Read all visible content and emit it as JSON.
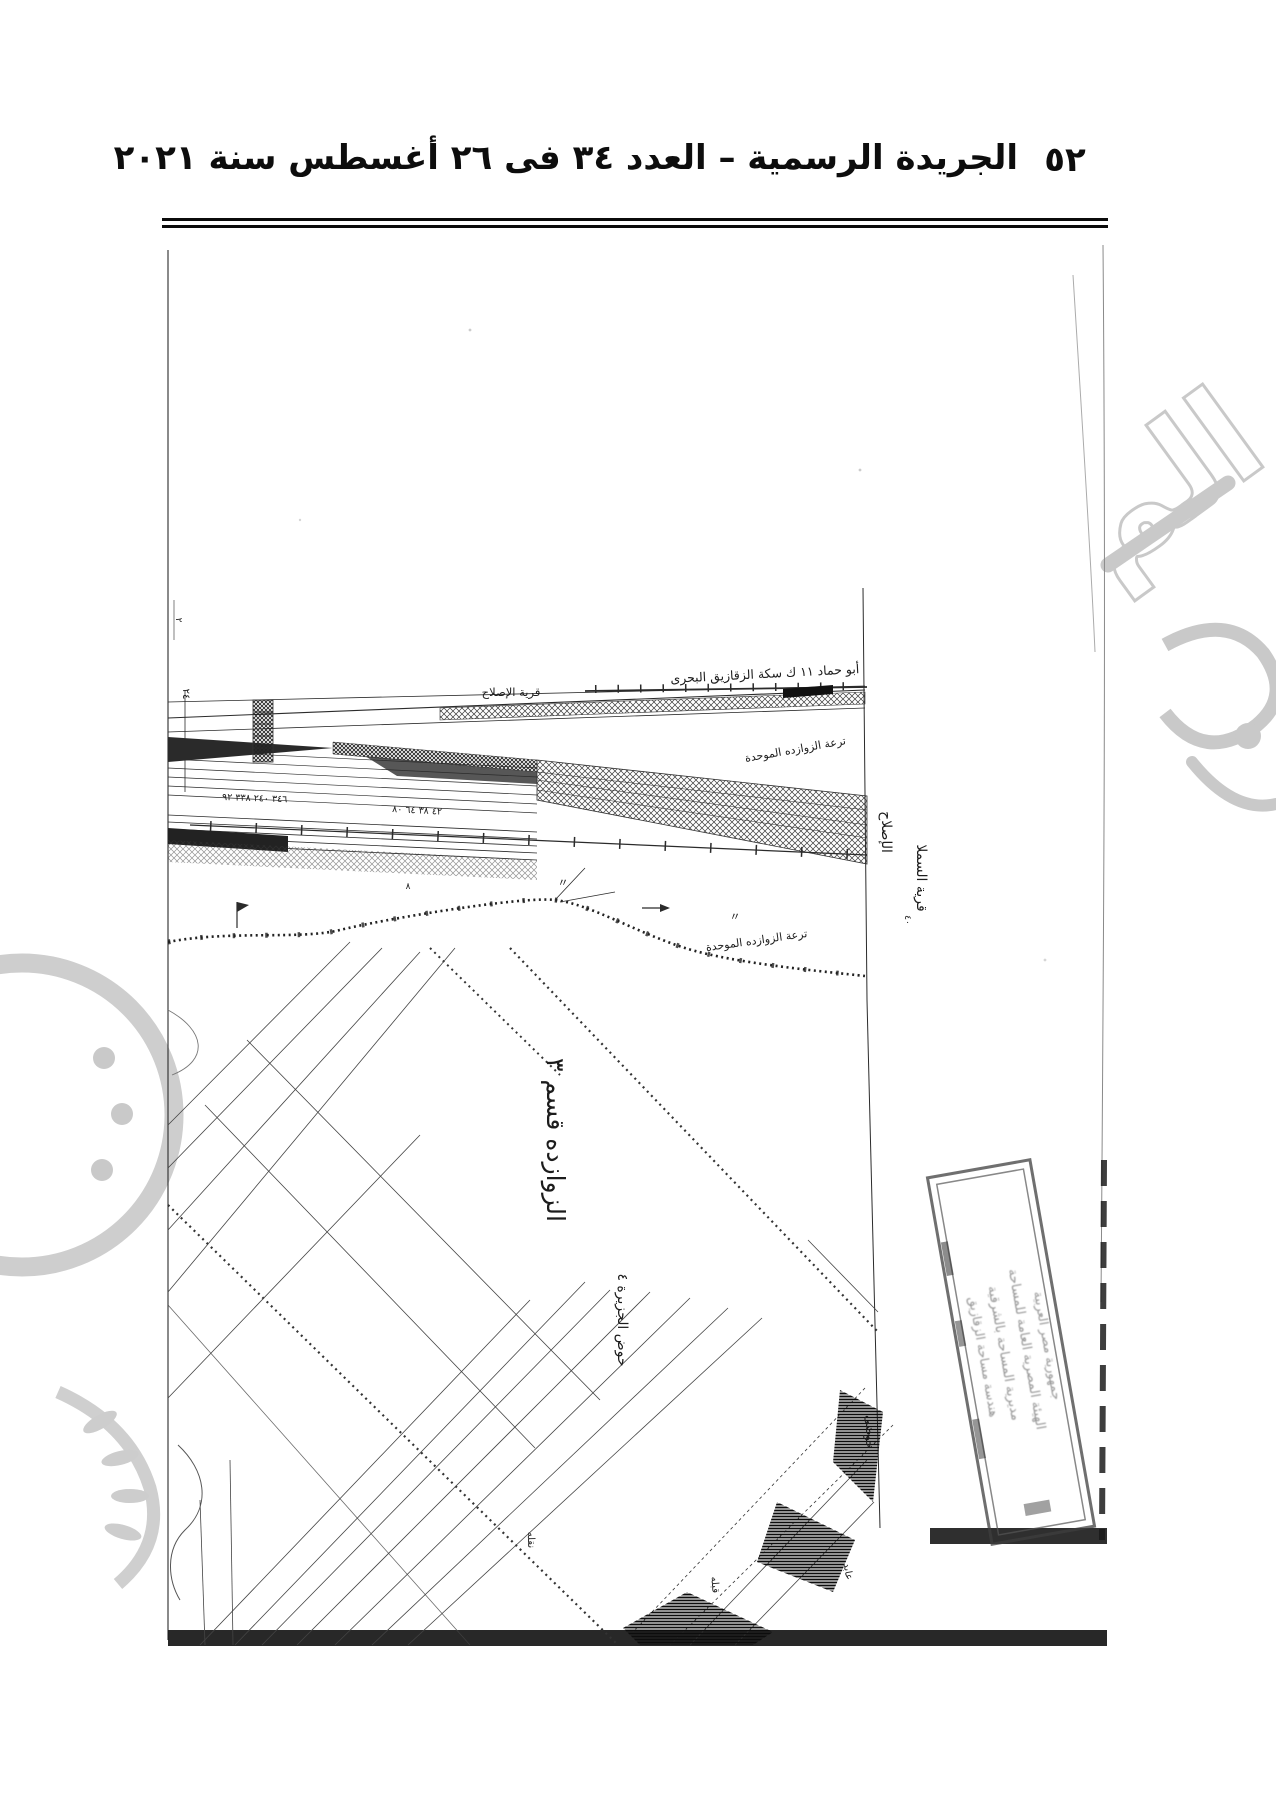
{
  "header": {
    "title": "الجريدة الرسمية – العدد ٣٤ فى ٢٦ أغسطس سنة ٢٠٢١",
    "page_number": "٥٢"
  },
  "map": {
    "labels": {
      "railway": "أبو حماد ١١ ك سكة الزقازيق البحرى",
      "village_top": "قرية الإصلاح",
      "canal_top": "ترعة الزوازده الموحدة",
      "canal_mid": "ترعة الزوازده الموحدة",
      "village_right": "قرية السملا",
      "village_right2": "الإصلاح",
      "right_small": "٤٠",
      "section": "الزوازده قسم ٣",
      "basin": "حوض الجزيرة ٤",
      "basin_small": "حوضى",
      "small1": "قبله",
      "small2": "عابد",
      "small3": "نقله",
      "left_num": "٢٤",
      "corner_mark": "٢",
      "survey_numbers_1": "٣٤٦ ٢٤٠ ٣٣٨ ٩٢",
      "survey_numbers_2": "٤٢ ٣٨ ٦٤ ٨٠",
      "ditto1": "〃",
      "ditto2": "〃",
      "circle_num": "٨"
    },
    "stamp": {
      "line1": "جمهورية مصر العربية",
      "line2": "الهيئة المصرية العامة للمساحة",
      "line3": "مديرية المساحة بالشرقية",
      "line4": "هندسة مساحة الزقازيق"
    }
  },
  "watermark": {
    "fragment": "الم"
  },
  "colors": {
    "ink": "#2b2b2b",
    "watermark": "#c9c9c9",
    "accent_dark": "#111111"
  }
}
